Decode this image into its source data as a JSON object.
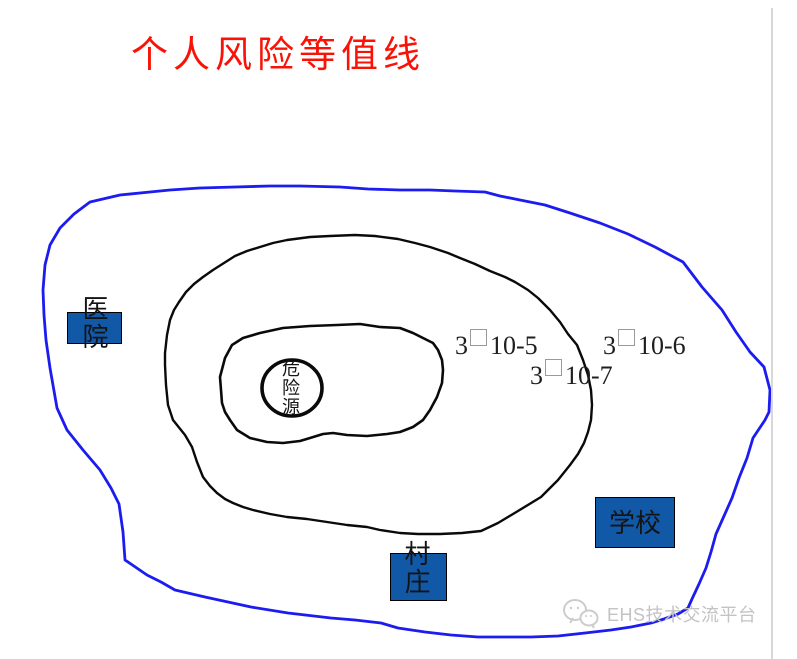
{
  "title": {
    "text": "个人风险等值线",
    "color": "#f91307"
  },
  "diagram": {
    "hazard_source": {
      "label": "危险源"
    },
    "buildings": {
      "hospital": {
        "label": "医院"
      },
      "school": {
        "label": "学校"
      },
      "village": {
        "label": "村庄"
      }
    },
    "risk_labels": {
      "level5": {
        "prefix": "3",
        "box": "□",
        "suffix": "10-5"
      },
      "level6": {
        "prefix": "3",
        "box": "□",
        "suffix": "10-6"
      },
      "level7": {
        "prefix": "3",
        "box": "□",
        "suffix": "10-7"
      }
    },
    "colors": {
      "outer_contour": "#1c1cf0",
      "inner_contours": "#0a0a0a",
      "building_fill": "#1158a7",
      "title_red": "#f91307"
    }
  },
  "watermark": {
    "logo": "chat-bubbles-logo",
    "text": "EHS技术交流平台"
  }
}
